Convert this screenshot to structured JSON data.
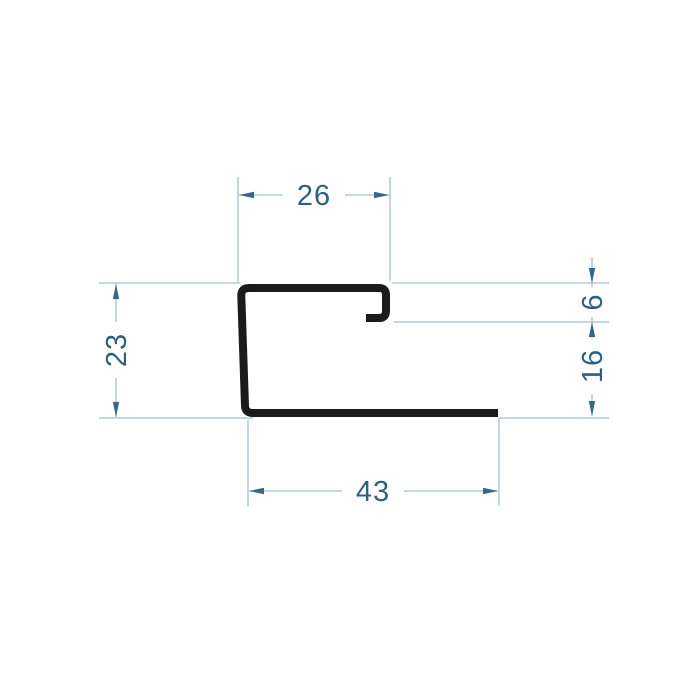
{
  "drawing": {
    "type": "technical-profile-cross-section",
    "background_color": "#ffffff",
    "profile_color": "#1b1b1b",
    "dimension_line_color": "#a3c0cc",
    "arrow_color": "#35678a",
    "text_color": "#2e6180",
    "dimensions": {
      "top_width": "26",
      "left_height": "23",
      "hook_height": "6",
      "lower_right_height": "16",
      "bottom_width": "43"
    }
  }
}
